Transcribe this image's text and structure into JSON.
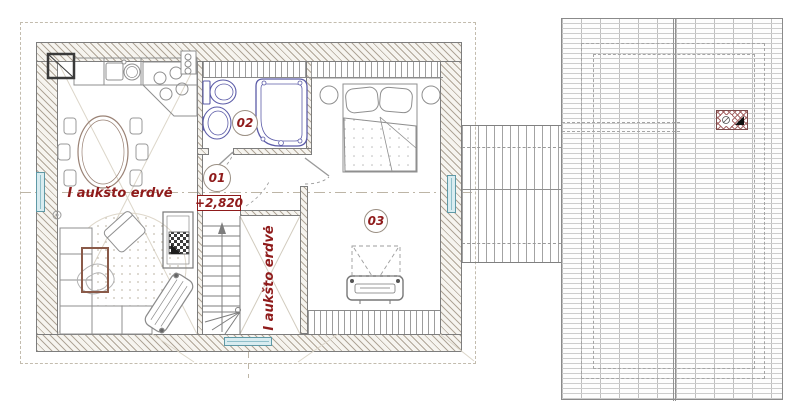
{
  "floor_plan": {
    "room_tags": {
      "hall": "01",
      "bathroom": "02",
      "bedroom": "03"
    },
    "elevation_mark": "+2,820",
    "void_label_living": "I aukšto erdvė",
    "void_label_stairwell": "I aukšto erdvė"
  },
  "colors": {
    "annotation_red": "#8f1b1b",
    "tag_circle_border": "#9a8f83",
    "window_glass": "#d9ecf0",
    "window_frame": "#5f99a6",
    "plumbing_blue": "#5c5ca8",
    "wall_hatch": "#b0a698",
    "furniture_line": "#8f8f8f",
    "roof_line": "#cccccc"
  }
}
